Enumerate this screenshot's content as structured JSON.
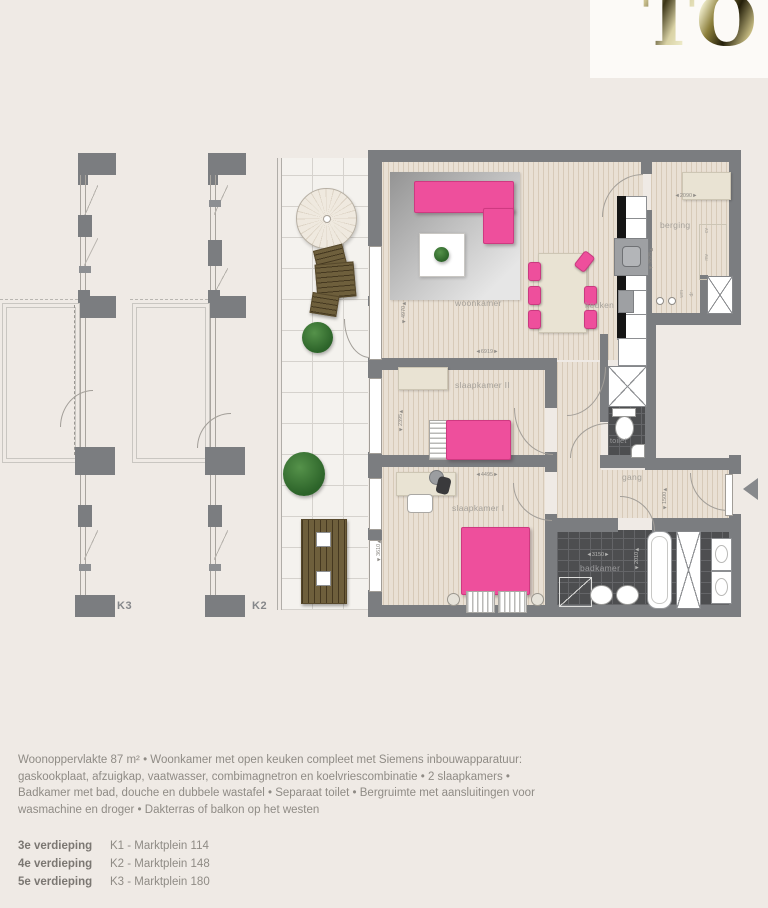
{
  "logo": {
    "text": "TO"
  },
  "plan": {
    "rooms": {
      "woonkamer": "woonkamer",
      "keuken": "keuken",
      "berging": "berging",
      "slaapkamer2": "slaapkamer II",
      "slaapkamer1": "slaapkamer I",
      "toilet": "toilet",
      "gang": "gang",
      "badkamer": "badkamer"
    },
    "small_labels": {
      "cv": "cv",
      "mv": "mv",
      "wm": "wm",
      "dr": "dr"
    },
    "dims": {
      "woonkamer_h": "4970",
      "woonkamer_w": "6919",
      "slk2_h": "2395",
      "slk1_w": "4495",
      "slk1_h": "3610",
      "berging_w": "2090",
      "berging_h": "3525",
      "gang_w": "1500",
      "badkamer_w": "3150",
      "badkamer_h": "2010"
    },
    "variant_labels": {
      "k3": "K3",
      "k2": "K2"
    }
  },
  "footer": {
    "description": "Woonoppervlakte 87 m² • Woonkamer met open keuken compleet met Siemens inbouwapparatuur: gaskookplaat, afzuigkap, vaatwasser, combimagnetron en koelvriescombinatie • 2 slaapkamers • Badkamer met bad, douche en dubbele wastafel • Separaat toilet • Bergruimte met aansluitingen voor wasmachine en droger • Dakterras of balkon op het westen",
    "floors": [
      {
        "floor": "3e verdieping",
        "unit": "K1 - Marktplein 114"
      },
      {
        "floor": "4e verdieping",
        "unit": "K2 - Marktplein 148"
      },
      {
        "floor": "5e verdieping",
        "unit": "K3 - Marktplein 180"
      }
    ]
  },
  "colors": {
    "accent_pink": "#ee4f9c",
    "wall": "#7b7d80",
    "gold": "#9a8c4a",
    "background": "#efeae5"
  }
}
